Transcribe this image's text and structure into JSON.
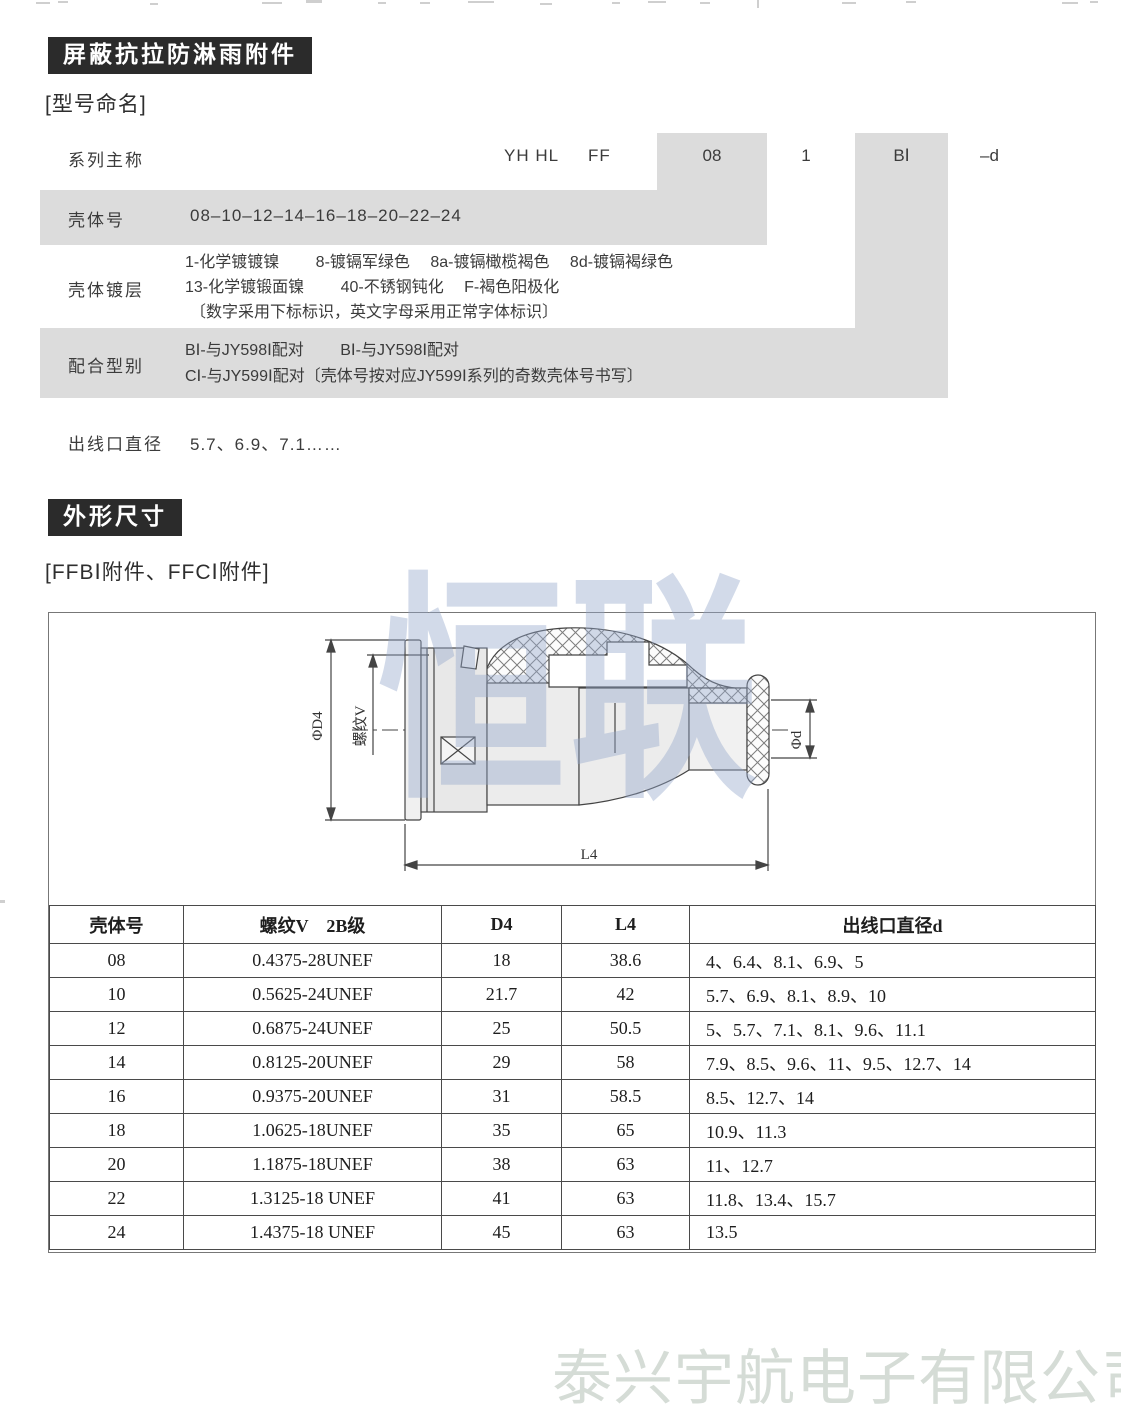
{
  "watermarks": {
    "center": "恒联",
    "footer": "泰兴宇航电子有限公司"
  },
  "shielding": {
    "title": "屏蔽抗拉防淋雨附件",
    "naming_heading": "[型号命名]",
    "code": {
      "series": "YH HL",
      "type": "FF",
      "shell": "08",
      "plating": "1",
      "mate": "BⅠ",
      "outlet": "–d"
    },
    "rows": {
      "series_label": "系列主称",
      "shell_label": "壳体号",
      "shell_value": "08–10–12–14–16–18–20–22–24",
      "plating_label": "壳体镀层",
      "plating_line1": "1-化学镀镀镍　　 8-镀镉军绿色　 8a-镀镉橄榄褐色　 8d-镀镉褐绿色",
      "plating_line2": "13-化学镀锻面镍　　 40-不锈钢钝化　 F-褐色阳极化",
      "plating_line3": "〔数字采用下标标识，英文字母采用正常字体标识〕",
      "mate_label": "配合型别",
      "mate_line1": "BⅠ-与JY598Ⅰ配对　　 BⅠ-与JY598Ⅰ配对",
      "mate_line2": "CⅠ-与JY599Ⅰ配对〔壳体号按对应JY599Ⅰ系列的奇数壳体号书写〕",
      "outlet_label": "出线口直径",
      "outlet_value": "5.7、6.9、7.1……"
    }
  },
  "dimensions": {
    "title": "外形尺寸",
    "subheading": "[FFBⅠ附件、FFCⅠ附件]",
    "drawing": {
      "dim_d4": "ΦD4",
      "dim_thread": "螺纹V",
      "dim_d": "Φd",
      "dim_l4": "L4"
    },
    "table": {
      "headers": [
        "壳体号",
        "螺纹V　2B级",
        "D4",
        "L4",
        "出线口直径d"
      ],
      "rows": [
        [
          "08",
          "0.4375-28UNEF",
          "18",
          "38.6",
          "4、6.4、8.1、6.9、5"
        ],
        [
          "10",
          "0.5625-24UNEF",
          "21.7",
          "42",
          "5.7、6.9、8.1、8.9、10"
        ],
        [
          "12",
          "0.6875-24UNEF",
          "25",
          "50.5",
          "5、5.7、7.1、8.1、9.6、11.1"
        ],
        [
          "14",
          "0.8125-20UNEF",
          "29",
          "58",
          "7.9、8.5、9.6、11、9.5、12.7、14"
        ],
        [
          "16",
          "0.9375-20UNEF",
          "31",
          "58.5",
          "8.5、12.7、14"
        ],
        [
          "18",
          "1.0625-18UNEF",
          "35",
          "65",
          "10.9、11.3"
        ],
        [
          "20",
          "1.1875-18UNEF",
          "38",
          "63",
          "11、12.7"
        ],
        [
          "22",
          "1.3125-18 UNEF",
          "41",
          "63",
          "11.8、13.4、15.7"
        ],
        [
          "24",
          "1.4375-18 UNEF",
          "45",
          "63",
          "13.5"
        ]
      ]
    }
  }
}
